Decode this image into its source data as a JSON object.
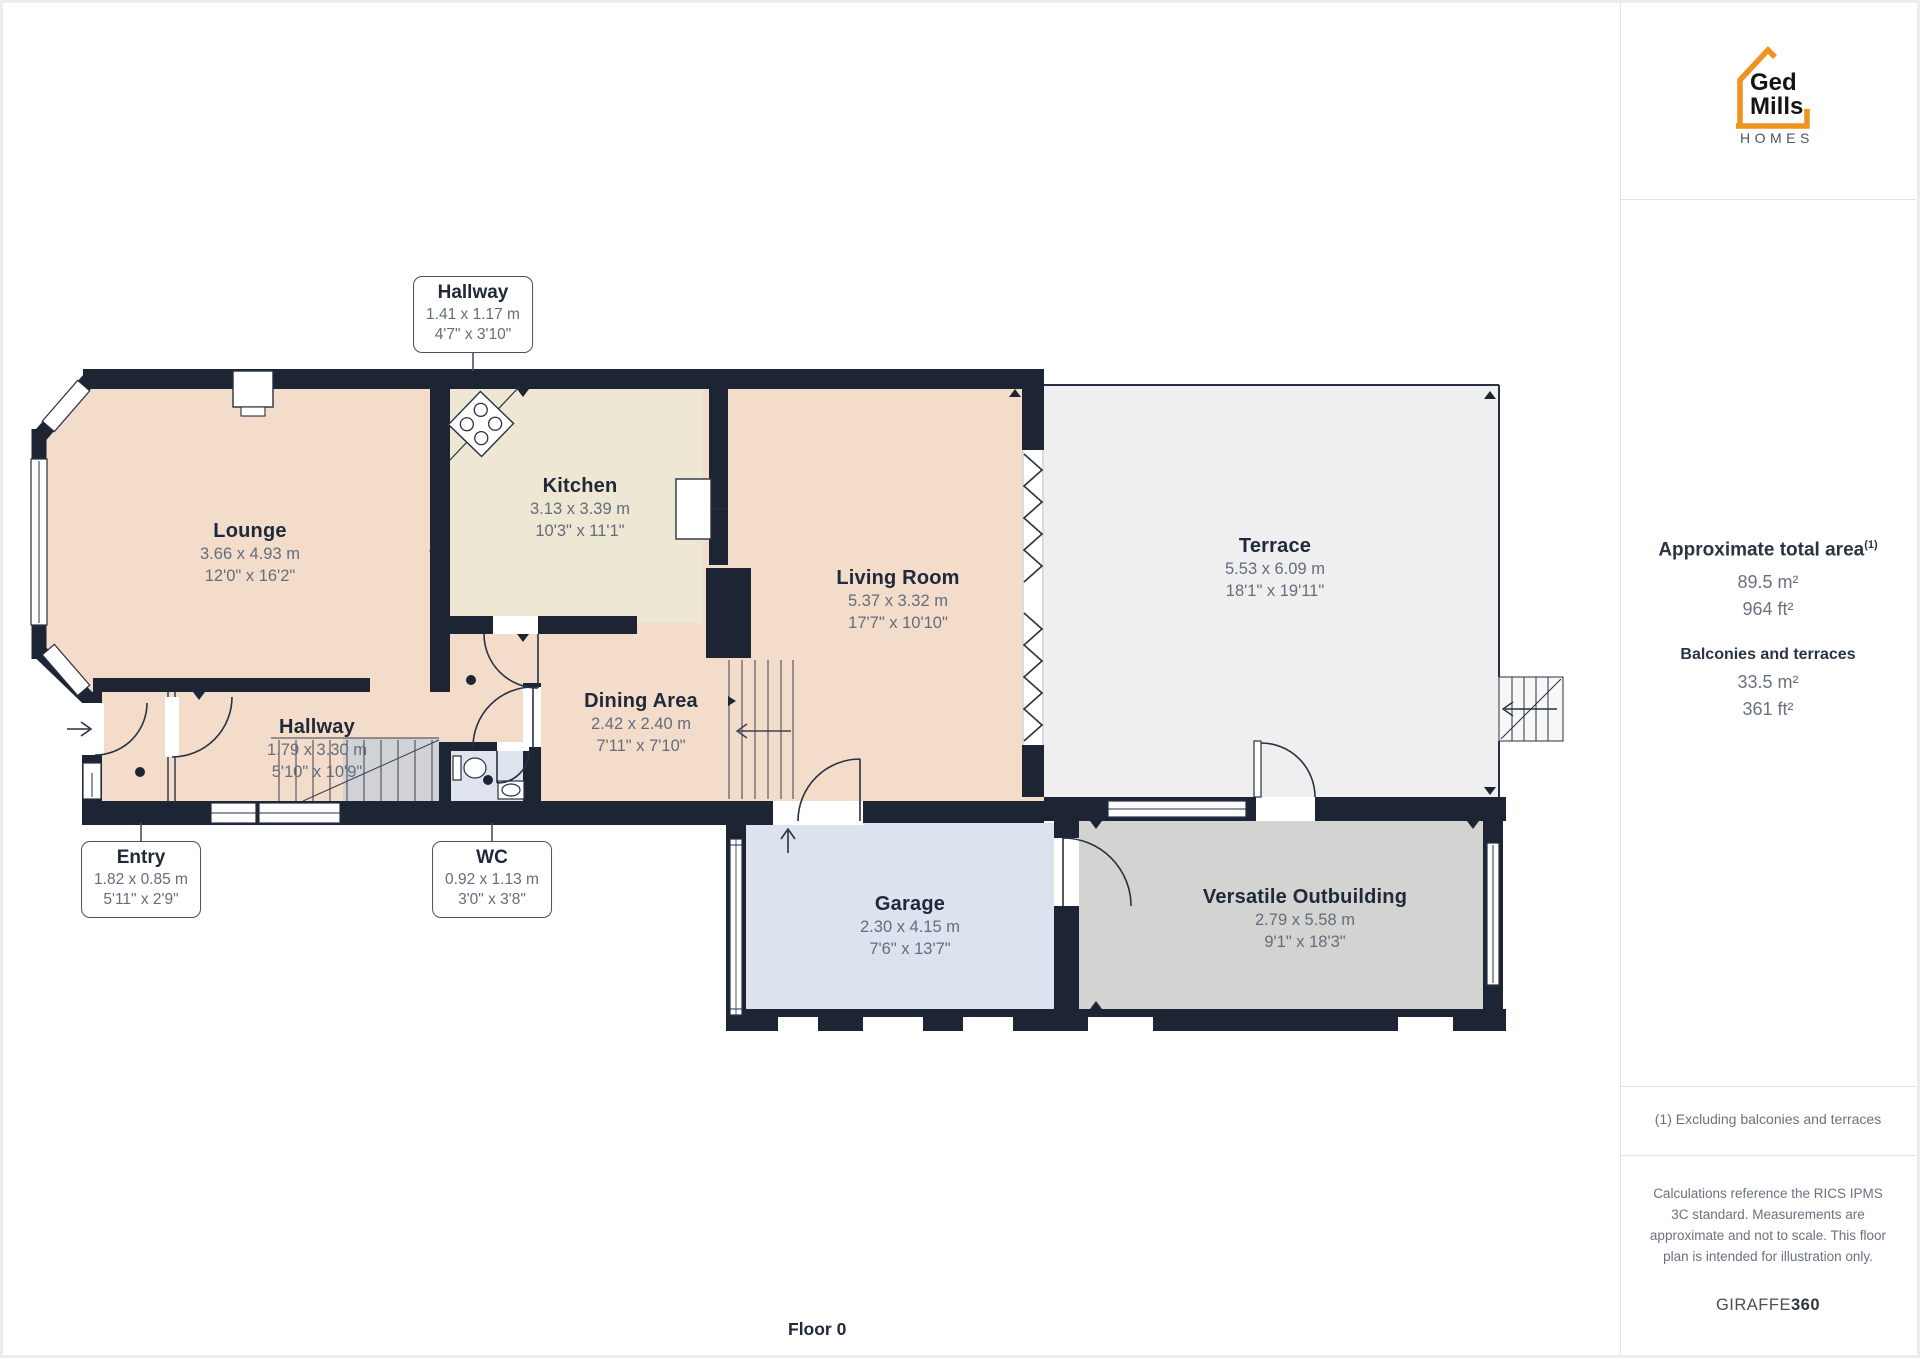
{
  "sidebar": {
    "logo": {
      "line1": "Ged",
      "line2": "Mills",
      "line3": "HOMES"
    },
    "area": {
      "title": "Approximate total area",
      "superscript": "(1)",
      "m2": "89.5 m²",
      "ft2": "964 ft²",
      "balconies_title": "Balconies and terraces",
      "balconies_m2": "33.5 m²",
      "balconies_ft2": "361 ft²"
    },
    "footnote": "(1) Excluding balconies and terraces",
    "disclaimer": "Calculations reference the RICS IPMS 3C standard. Measurements are approximate and not to scale. This floor plan is intended for illustration only.",
    "brand": {
      "name": "GIRAFFE",
      "suffix": "360"
    }
  },
  "floor_label": "Floor 0",
  "rooms": [
    {
      "name": "Lounge",
      "metric": "3.66 x 4.93 m",
      "imperial": "12'0\" x 16'2\""
    },
    {
      "name": "Kitchen",
      "metric": "3.13 x 3.39 m",
      "imperial": "10'3\" x 11'1\""
    },
    {
      "name": "Living Room",
      "metric": "5.37 x 3.32 m",
      "imperial": "17'7\" x 10'10\""
    },
    {
      "name": "Terrace",
      "metric": "5.53 x 6.09 m",
      "imperial": "18'1\" x 19'11\""
    },
    {
      "name": "Dining Area",
      "metric": "2.42 x 2.40 m",
      "imperial": "7'11\" x 7'10\""
    },
    {
      "name": "Hallway",
      "metric": "1.79 x 3.30 m",
      "imperial": "5'10\" x 10'9\""
    },
    {
      "name": "Garage",
      "metric": "2.30 x 4.15 m",
      "imperial": "7'6\" x 13'7\""
    },
    {
      "name": "Versatile Outbuilding",
      "metric": "2.79 x 5.58 m",
      "imperial": "9'1\" x 18'3\""
    }
  ],
  "callouts": [
    {
      "name": "Hallway",
      "metric": "1.41 x 1.17 m",
      "imperial": "4'7\" x 3'10\""
    },
    {
      "name": "Entry",
      "metric": "1.82 x 0.85 m",
      "imperial": "5'11\" x 2'9\""
    },
    {
      "name": "WC",
      "metric": "0.92 x 1.13 m",
      "imperial": "3'0\" x 3'8\""
    }
  ],
  "colors": {
    "wall": "#1d2534",
    "room_salmon": "#f3dcca",
    "room_cream": "#ede7d4",
    "room_bluegray": "#dce3ee",
    "room_gray": "#d3d3d1",
    "terrace": "#efeff0",
    "logo_orange": "#f0921e",
    "dim_text": "#636d7c",
    "title_text": "#20293a"
  }
}
